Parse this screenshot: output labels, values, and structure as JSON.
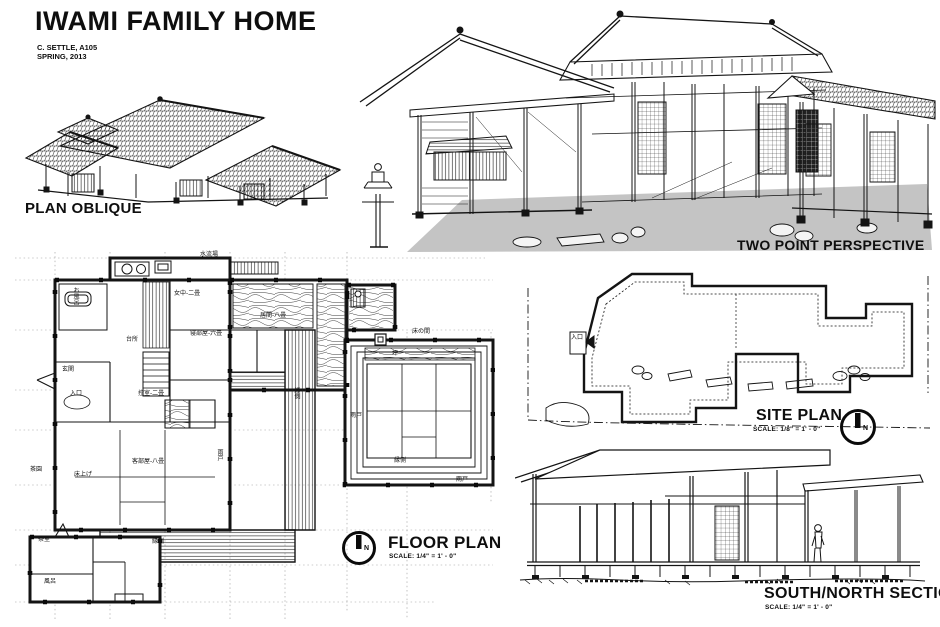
{
  "sheet": {
    "title": "IWAMI FAMILY HOME",
    "author": "C. SETTLE, A105",
    "date": "SPRING, 2013"
  },
  "labels": {
    "plan_oblique": "PLAN OBLIQUE",
    "two_point_perspective": "TWO POINT PERSPECTIVE",
    "floor_plan": "FLOOR PLAN",
    "floor_plan_scale": "SCALE: 1/4\" = 1' - 0\"",
    "site_plan": "SITE PLAN",
    "site_plan_scale": "SCALE: 1/8\" = 1' - 0\"",
    "section": "SOUTH/NORTH SECTION",
    "section_scale": "SCALE: 1/4\" = 1' - 0\"",
    "north": "N"
  },
  "floor_plan_rooms": [
    {
      "text": "水流場"
    },
    {
      "text": "女中-二畳"
    },
    {
      "text": "お風呂"
    },
    {
      "text": "台所"
    },
    {
      "text": "居間-八畳"
    },
    {
      "text": "寝部屋-六畳"
    },
    {
      "text": "床の間"
    },
    {
      "text": "坪"
    },
    {
      "text": "玄関"
    },
    {
      "text": "入口"
    },
    {
      "text": "控室-二畳"
    },
    {
      "text": "雨戸"
    },
    {
      "text": "客部屋-八畳"
    },
    {
      "text": "茶園"
    },
    {
      "text": "床上げ"
    },
    {
      "text": "縁側"
    },
    {
      "text": "縁側"
    },
    {
      "text": "雨戸"
    },
    {
      "text": "茶室"
    },
    {
      "text": "縁側"
    },
    {
      "text": "風呂"
    },
    {
      "text": "雨戸"
    }
  ],
  "site_plan": {
    "entry_label": "入口"
  },
  "colors": {
    "ink": "#141414",
    "paper": "#ffffff",
    "ground_shade": "#c4c4c4",
    "grid_dash": "#9a9a9a"
  }
}
